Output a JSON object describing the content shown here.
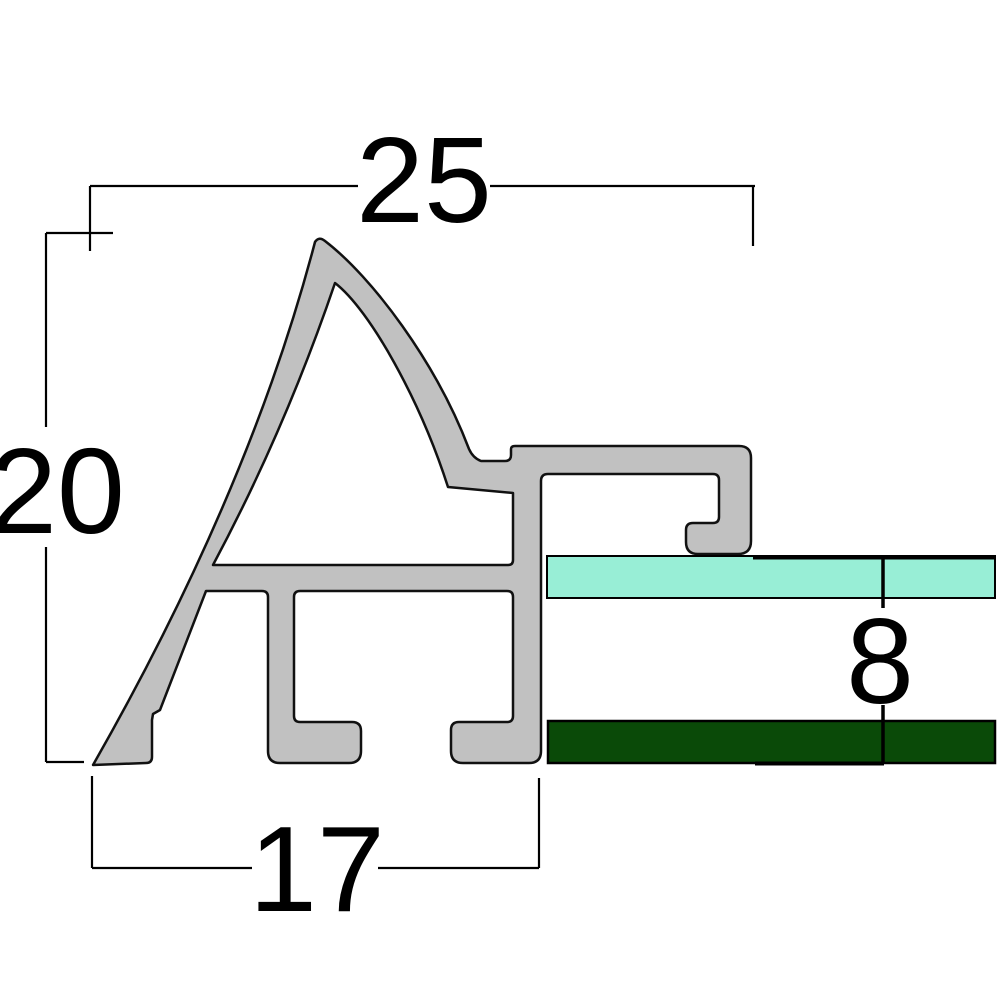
{
  "diagram": {
    "title": "aluminum frame profile cross-section",
    "dimensions": {
      "top": {
        "label": "25"
      },
      "left": {
        "label": "20"
      },
      "bottom": {
        "label": "17"
      },
      "right": {
        "label": "8"
      }
    },
    "colors": {
      "background": "#ffffff",
      "profile_fill": "#c1c1c1",
      "profile_outline": "#111111",
      "glass_fill": "#98eed6",
      "backboard_fill": "#0a4a08",
      "line_color": "#000000"
    }
  }
}
